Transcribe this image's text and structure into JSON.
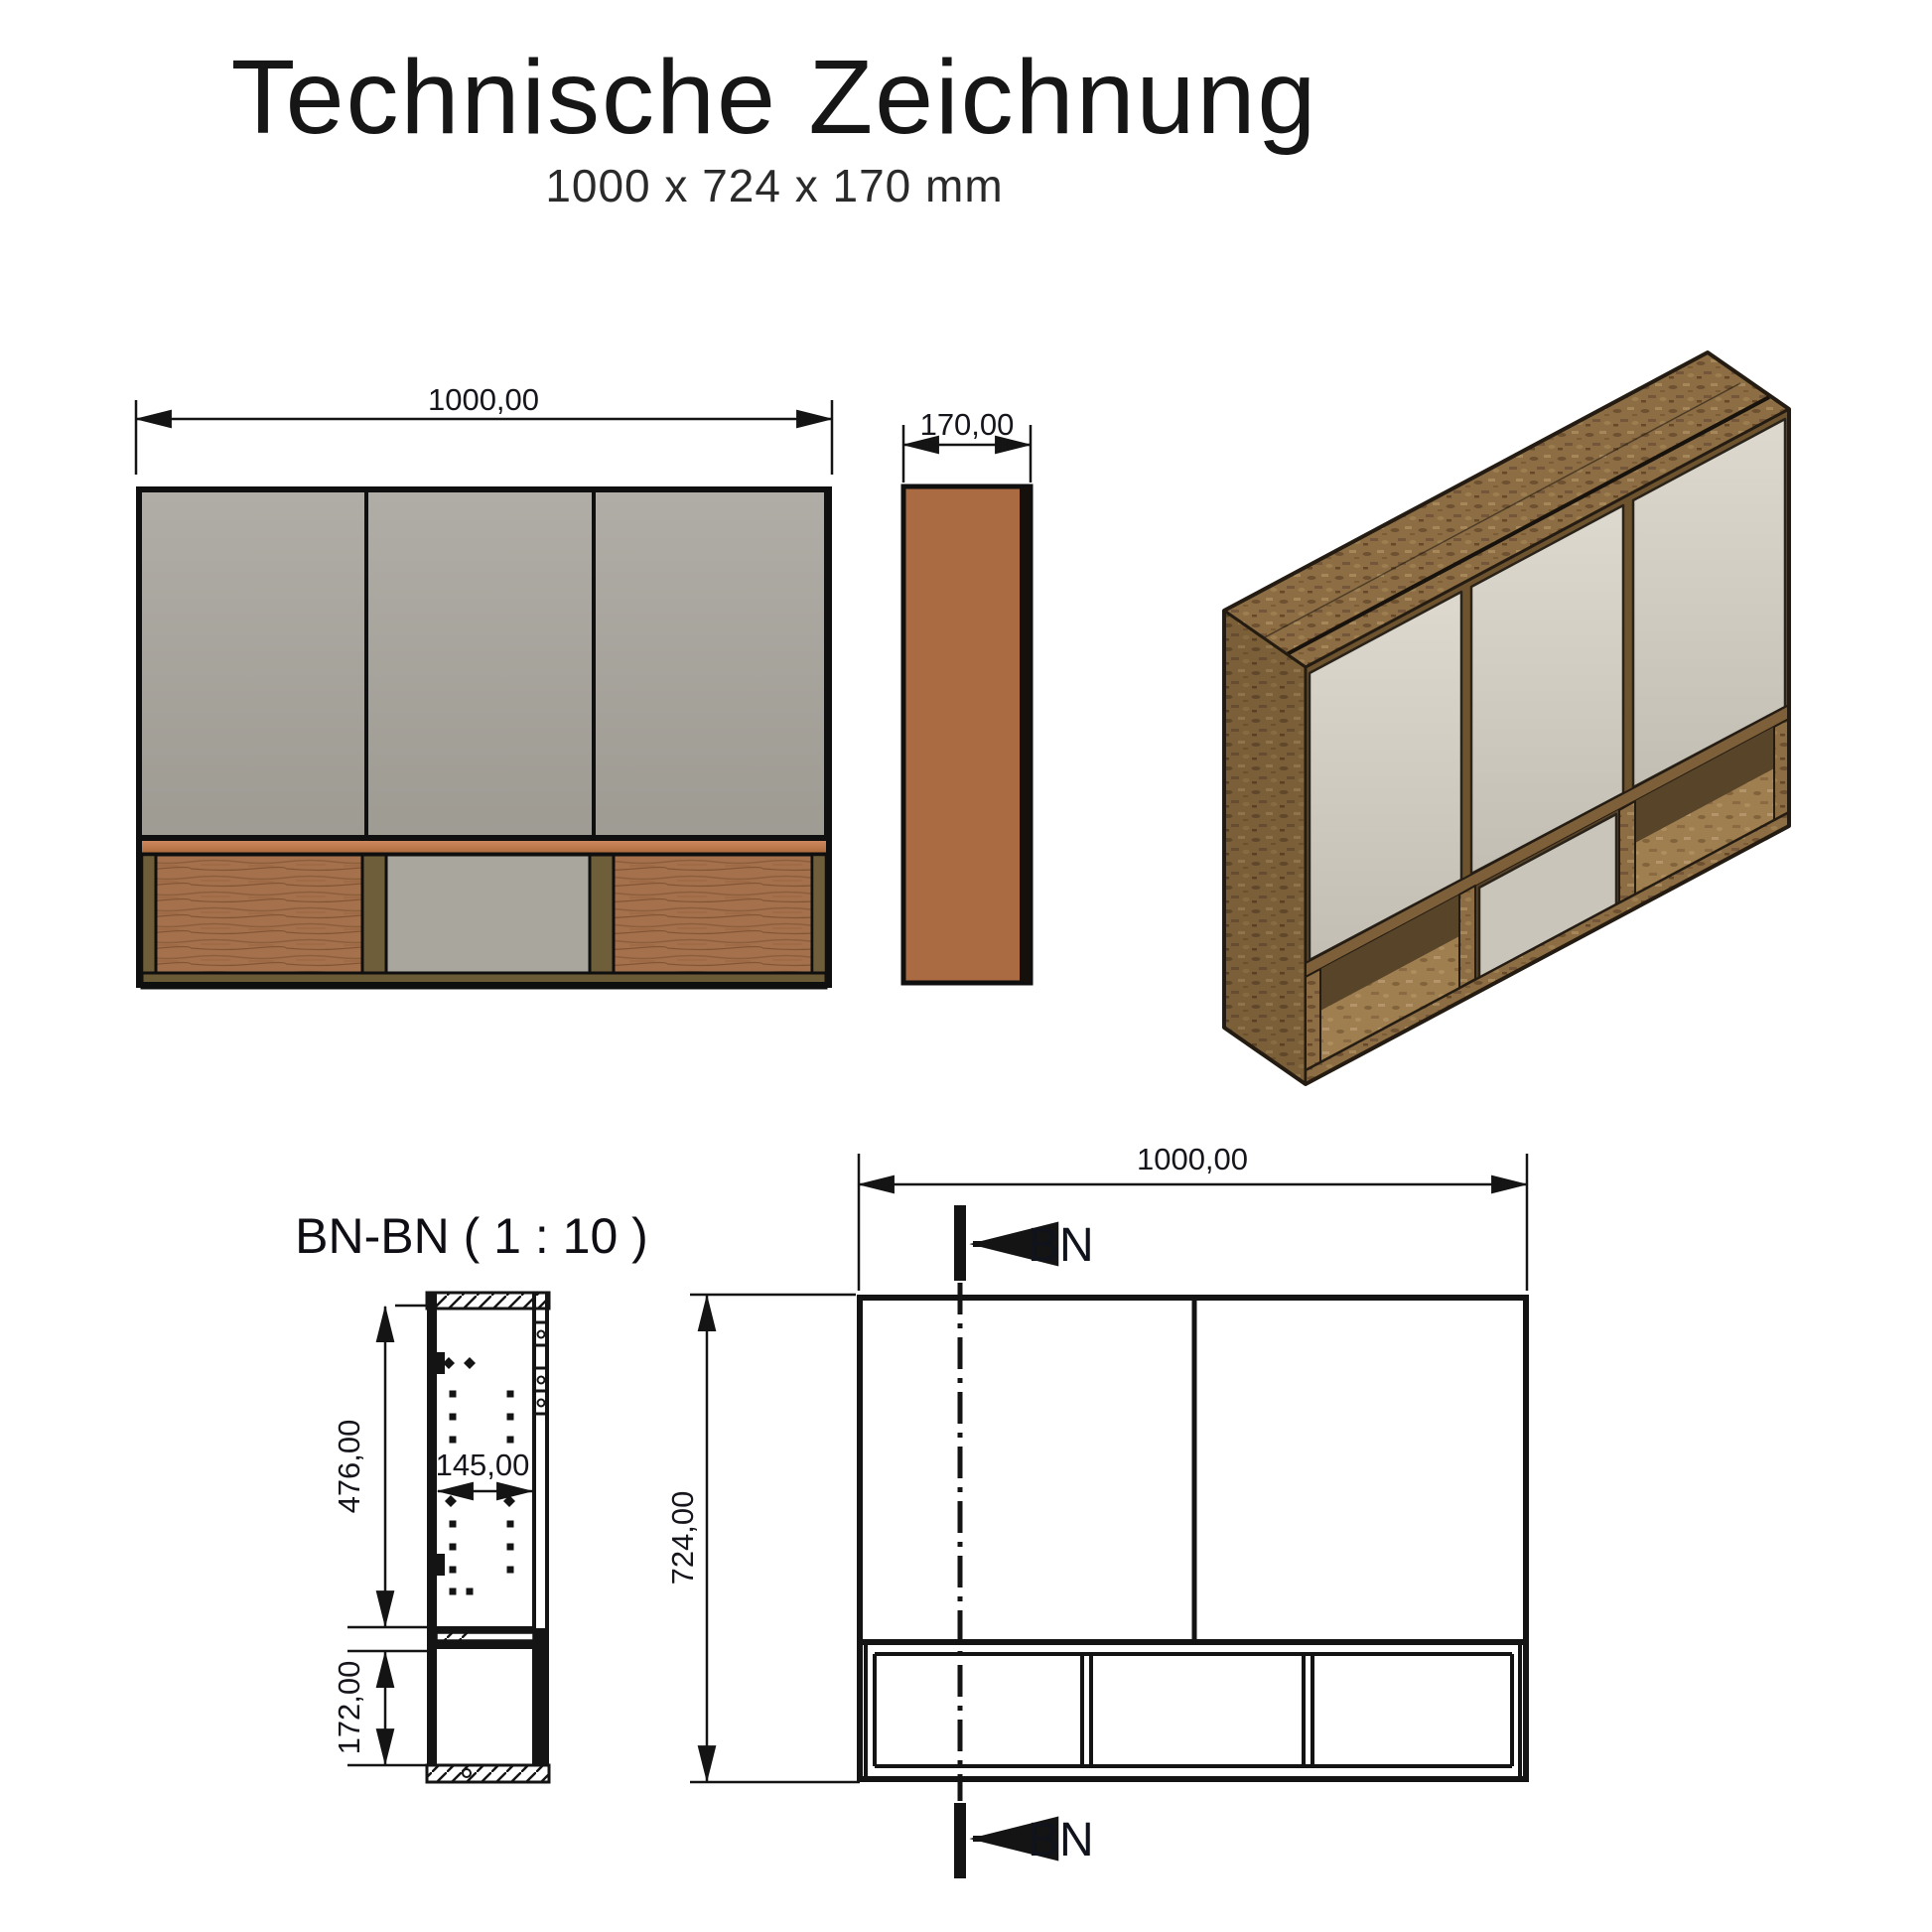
{
  "header": {
    "title": "Technische Zeichnung",
    "subtitle": "1000 x 724 x 170 mm"
  },
  "front_view": {
    "width_dim": "1000,00"
  },
  "side_view": {
    "depth_dim": "170,00"
  },
  "section_view": {
    "title": "BN-BN ( 1 : 10 )",
    "upper_height_dim": "476,00",
    "inner_depth_dim": "145,00",
    "lower_height_dim": "172,00"
  },
  "elevation_view": {
    "width_dim": "1000,00",
    "height_dim": "724,00",
    "section_marker_top": "BN",
    "section_marker_bottom": "BN"
  },
  "colors": {
    "door_gray": "#a8a49c",
    "compartment_gray": "#a9a69e",
    "wood_strip_orange": "#bf7a4a",
    "side_panel_brown": "#aa6b43",
    "osb_wood": "#8d6e44",
    "olive_wood": "#6f5e3a",
    "line_black": "#141414"
  }
}
